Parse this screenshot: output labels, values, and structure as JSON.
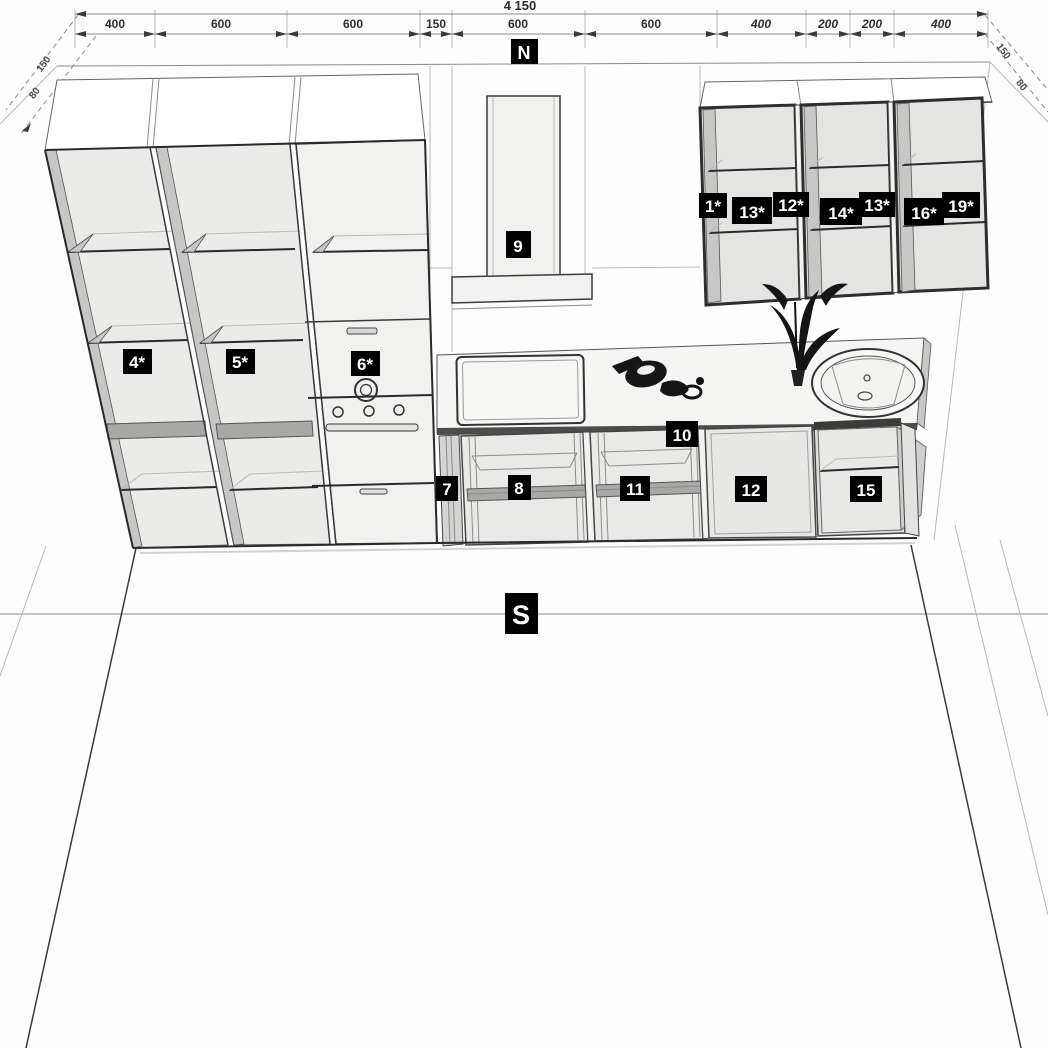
{
  "compass": {
    "north": "N",
    "south": "S"
  },
  "dimensions": {
    "total": "4 150",
    "segments": [
      "400",
      "600",
      "600",
      "150",
      "600",
      "600",
      "400",
      "200",
      "200",
      "400"
    ],
    "left_offsets": [
      "150",
      "80"
    ],
    "right_offsets": [
      "150",
      "80"
    ]
  },
  "tags": {
    "wall_cabinets": [
      "1*",
      "13*",
      "12*",
      "14*",
      "13*",
      "16*",
      "19*"
    ],
    "tall_cabinets": [
      "4*",
      "5*",
      "6*"
    ],
    "hood": "9",
    "worktop": "10",
    "base_cabinets": [
      "7",
      "8",
      "11",
      "12",
      "15"
    ]
  },
  "colors": {
    "tag_background": "#000000",
    "tag_text": "#ffffff",
    "line": "#3a3a3a",
    "panel": "#f1f1ef",
    "background": "#fdfdfd"
  }
}
